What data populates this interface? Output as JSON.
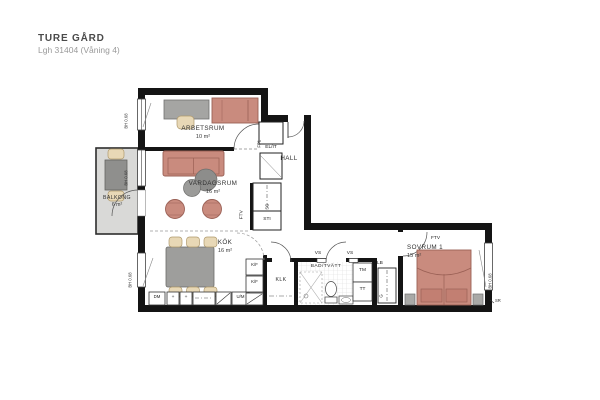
{
  "header": {
    "title": "TURE GÅRD",
    "subtitle": "Lgh 31404 (Våning 4)"
  },
  "rooms": {
    "arbetsrum": {
      "name": "ARBETSRUM",
      "area": "10 m²"
    },
    "vardagsrum": {
      "name": "VARDAGSRUM",
      "area": "16 m²"
    },
    "kok": {
      "name": "KÖK",
      "area": "16 m²"
    },
    "hall": {
      "name": "HALL"
    },
    "balkong": {
      "name": "BALKONG",
      "area": "6 m²"
    },
    "sovrum1": {
      "name": "SOVRUM 1",
      "area": "15 m²"
    },
    "klk": {
      "name": "KLK"
    },
    "badtvatt": {
      "name": "BAD/TVÄTT"
    }
  },
  "fixtures": {
    "elit": "EL/IT",
    "fp1": "FP1",
    "ftv": "FTV",
    "sg": "SG",
    "sti": "STI",
    "vs": "VS",
    "tm": "TM",
    "tt": "TT",
    "lb": "LB",
    "g": "G",
    "kf": "K/F",
    "dm": "DM",
    "um": "U/M",
    "sr": "SR",
    "plus": "+",
    "window_height": "BH 0.68"
  },
  "colors": {
    "wall": "#141414",
    "furniture_red": "#c98b7e",
    "furniture_red_stroke": "#9a6055",
    "furniture_gray": "#9e9e9c",
    "chair_beige": "#e8d8b6",
    "balcony_floor": "#d9d9d7"
  }
}
